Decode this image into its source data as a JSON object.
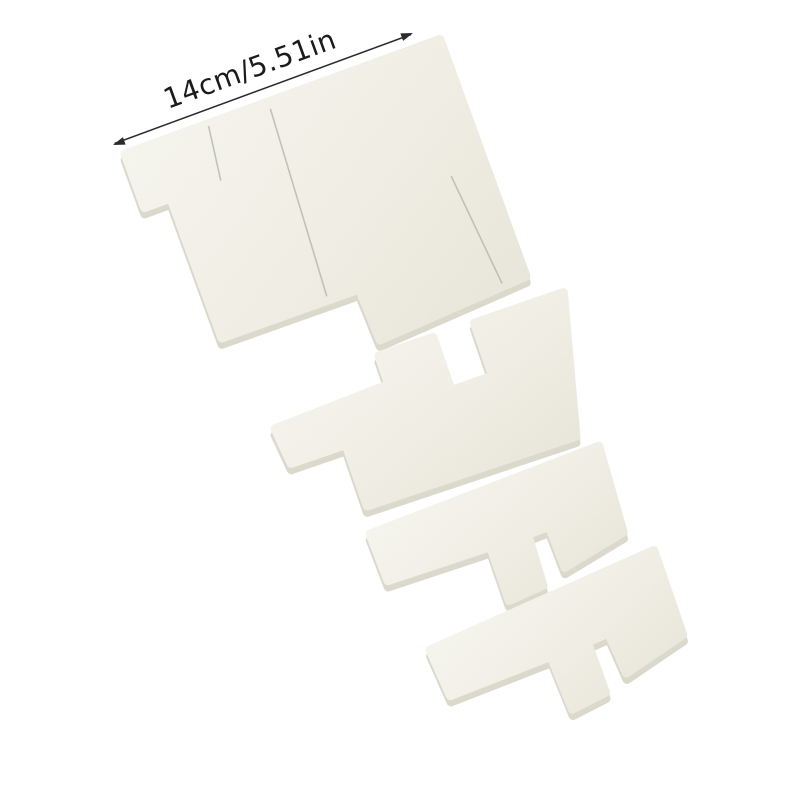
{
  "image": {
    "type": "product photo",
    "subject": "Set of 4 white foam waste ink absorber sponge pads arranged diagonally on a plain white background",
    "background_color": "#ffffff"
  },
  "annotation": {
    "label": "14cm/5.51in",
    "label_color": "#1b1b1b",
    "arrow_color": "#2b2b2b",
    "arrow_style": "thin double-headed measurement arrow, tilted about -20 degrees, above the largest pad"
  },
  "foam": {
    "fill_light": "#f7f6ef",
    "fill_dark": "#e9e7da",
    "side_shadow_color": "#d7d5c7",
    "seam_color": "#b7b6a7"
  },
  "pieces": [
    {
      "id": "piece-1",
      "description": "largest pad (top left), stepped notch on left edge, stepped bottom edge, center seam and two cut slits"
    },
    {
      "id": "piece-2",
      "description": "wide pad with square notch cut into top edge and thin tail extending to lower left"
    },
    {
      "id": "piece-3",
      "description": "bar-shaped pad with small tab and wide foot hanging from its underside"
    },
    {
      "id": "piece-4",
      "description": "bar-shaped pad with small tab and wide foot hanging from its underside, lowest right position"
    }
  ]
}
